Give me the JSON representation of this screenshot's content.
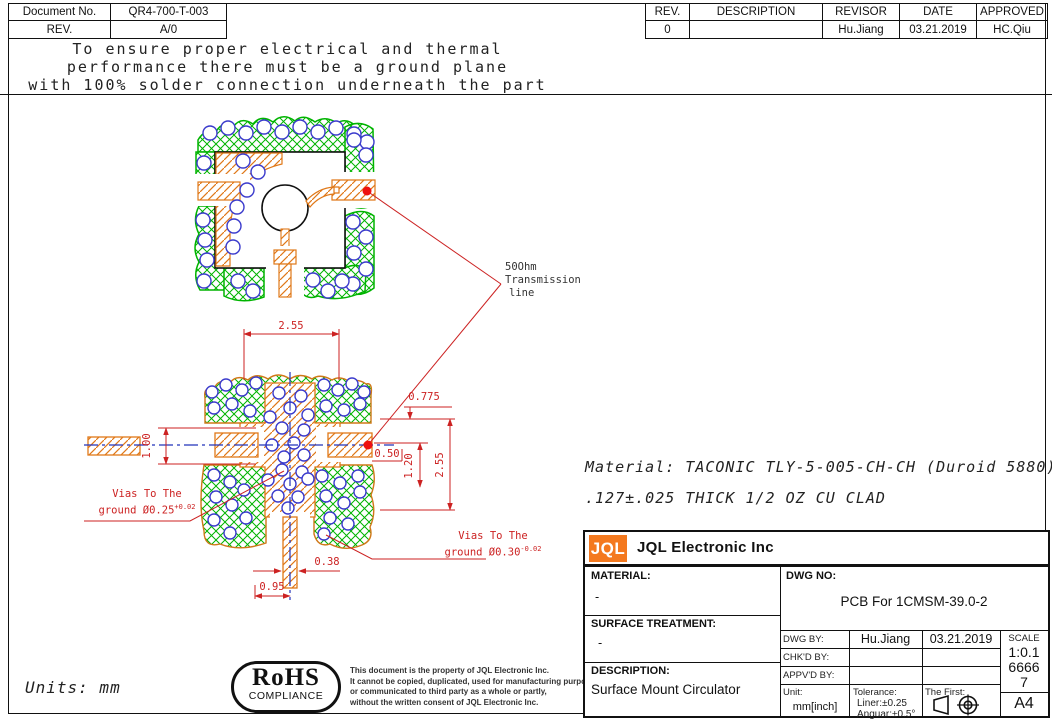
{
  "doc_info": {
    "doc_no_label": "Document No.",
    "doc_no": "QR4-700-T-003",
    "rev_label": "REV.",
    "rev": "A/0"
  },
  "revision_table": {
    "headers": [
      "REV.",
      "DESCRIPTION",
      "REVISOR",
      "DATE",
      "APPROVED"
    ],
    "row": {
      "rev": "0",
      "description": "",
      "revisor": "Hu.Jiang",
      "date": "03.21.2019",
      "approved": "HC.Qiu"
    }
  },
  "note": {
    "line1": "To ensure proper electrical and thermal",
    "line2": "performance there must be a ground plane",
    "line3": "with 100% solder connection underneath the part"
  },
  "labels": {
    "transmission_l1": "50Ohm",
    "transmission_l2": "Transmission",
    "transmission_l3": "line",
    "vias_left_l1": "Vias To The",
    "vias_left_l2": "ground Ø0.25",
    "vias_left_tol": "+0.02",
    "vias_right_l1": "Vias To The",
    "vias_right_l2": "ground Ø0.30",
    "vias_right_tol": "-0.02"
  },
  "dimensions": {
    "top_width": "2.55",
    "pad_height": "1.00",
    "pad_offset": "0.775",
    "gap": "0.50",
    "inner_height": "1.20",
    "total_height": "2.55",
    "stub_width": "0.38",
    "stub_offset": "0.95"
  },
  "material_note": {
    "line1": "Material: TACONIC TLY-5-005-CH-CH (Duroid 5880)",
    "line2": ".127±.025 THICK 1/2 OZ CU CLAD"
  },
  "units_note": "Units:  mm",
  "rohs": {
    "title": "RoHS",
    "subtitle": "COMPLIANCE",
    "disclaimer_l1": "This document is the property of JQL Electronic Inc.",
    "disclaimer_l2": "It cannot be copied, duplicated, used for manufacturing purposes",
    "disclaimer_l3": "or communicated to third party as a whole or partly,",
    "disclaimer_l4": "without the written consent of JQL Electronic Inc."
  },
  "title_block": {
    "logo": "JQL",
    "company": "JQL Electronic Inc",
    "material_label": "MATERIAL:",
    "material_value": "-",
    "surface_label": "SURFACE TREATMENT:",
    "surface_value": "-",
    "description_label": "DESCRIPTION:",
    "description_value": "Surface Mount Circulator",
    "dwg_no_label": "DWG NO:",
    "dwg_no_value": "PCB For 1CMSM-39.0-2",
    "dwg_by_label": "DWG BY:",
    "dwg_by": "Hu.Jiang",
    "dwg_date": "03.21.2019",
    "chk_label": "CHK'D BY:",
    "appv_label": "APPV'D BY:",
    "scale_label": "SCALE",
    "scale_value_l1": "1:0.1",
    "scale_value_l2": "6666",
    "scale_value_l3": "7",
    "paper_size": "A4",
    "unit_label": "Unit:",
    "unit_value": "mm[inch]",
    "tolerance_label": "Tolerance:",
    "tolerance_liner": "Liner:±0.25",
    "tolerance_anguar": "Anguar:±0.5°",
    "first_angle_label": "The First:"
  },
  "colors": {
    "ground_hatch_green": "#00b400",
    "copper_hatch_orange": "#e07818",
    "via_blue": "#3a3acc",
    "dimension_red": "#cc2222",
    "marker_red": "#ee1111",
    "logo_orange": "#f4791f"
  }
}
